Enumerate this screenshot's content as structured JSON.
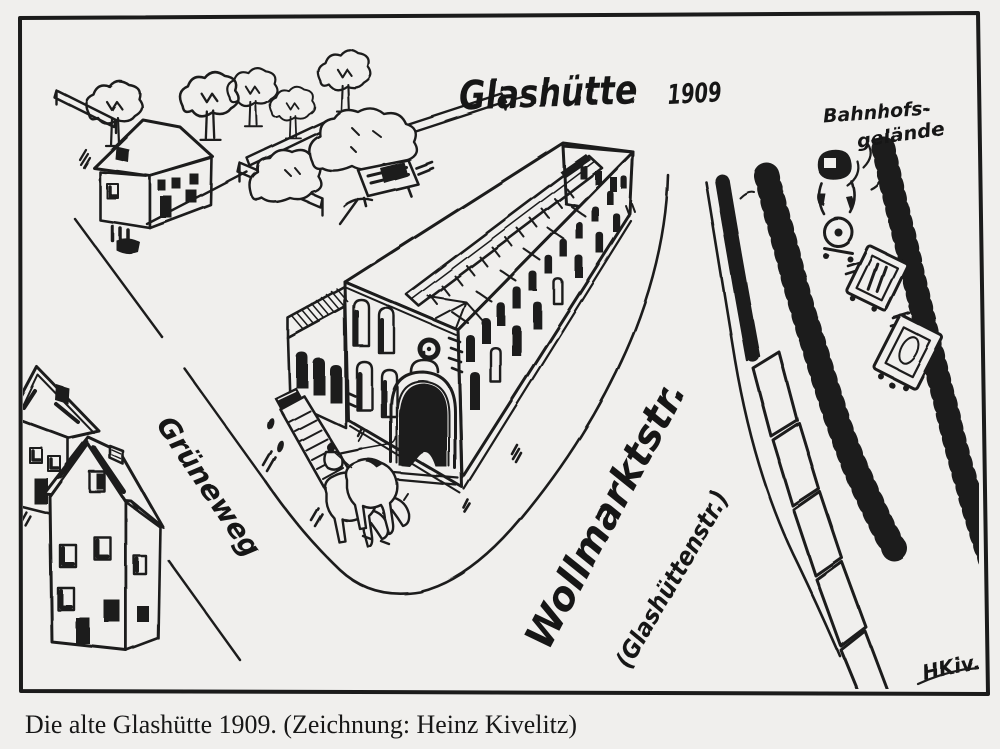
{
  "colors": {
    "paper": "#f0efed",
    "ink": "#1b1b1b"
  },
  "scene": {
    "title": "Glashütte",
    "title_year": "1909",
    "label_bahnhof_line1": "Bahnhofs-",
    "label_bahnhof_line2": "gelände",
    "label_grueneweg": "Grüneweg",
    "label_wollmarktstr": "Wollmarktstr.",
    "label_glashuettenstr": "(Glashüttenstr.)",
    "signature": "HKiv."
  },
  "caption": {
    "text": "Die alte Glashütte 1909. (Zeichnung: Heinz Kivelitz)"
  }
}
